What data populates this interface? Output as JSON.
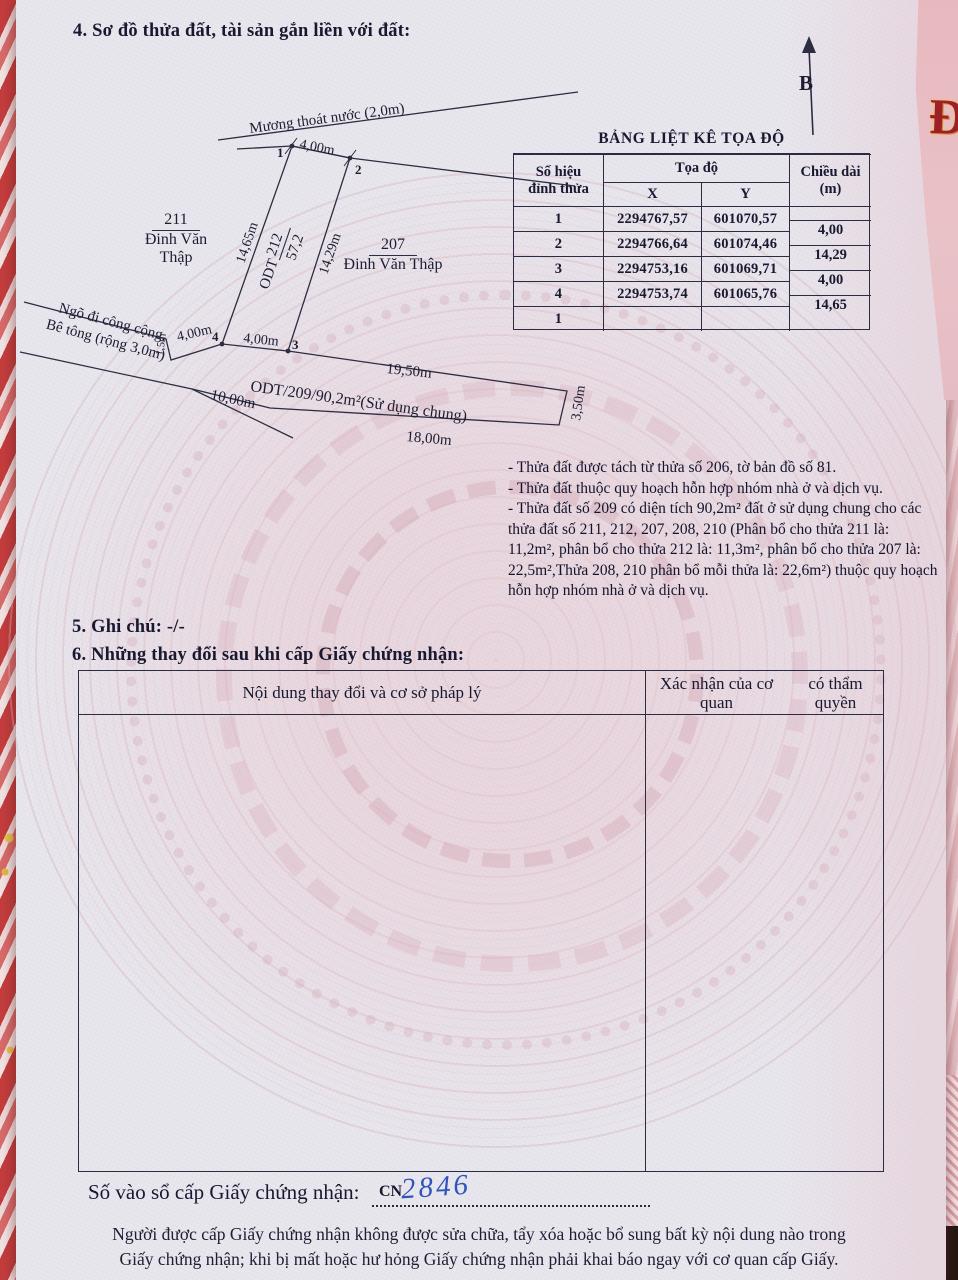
{
  "sections": {
    "sec4_title": "4. Sơ đồ thửa đất, tài sản gắn liền với đất:",
    "sec5_title": "5. Ghi chú: -/-",
    "sec6_title": "6. Những thay đổi sau khi cấp Giấy chứng nhận:"
  },
  "diagram": {
    "north_label": "B",
    "ditch_label": "Mương thoát nước (2,0m)",
    "top_edge": "4,00m",
    "left_edge": "14,65m",
    "right_edge": "14,29m",
    "front_edge_left": "4,00m",
    "front_edge_mid": "4,00m",
    "jog": "1,5m",
    "vertex1": "1",
    "vertex2": "2",
    "vertex3": "3",
    "vertex4": "4",
    "plot_prefix": "ODT",
    "plot_number": "212",
    "plot_area": "57,2",
    "neighbor_left_number": "211",
    "neighbor_left_owner": "Đinh Văn Thập",
    "neighbor_right_number": "207",
    "neighbor_right_owner": "Đinh Văn Thập",
    "path_label_line1": "Ngõ đi công cộng.",
    "path_label_line2": "Bê tông (rộng 3,0m)",
    "path_length": "10,00m",
    "strip_label": "ODT/209/90,2m²(Sử dụng chung)",
    "strip_top": "19,50m",
    "strip_bottom": "18,00m",
    "strip_right": "3,50m"
  },
  "coord_table": {
    "title": "BẢNG LIỆT KÊ TỌA ĐỘ",
    "headers": {
      "col1_line1": "Số hiệu",
      "col1_line2": "đỉnh thửa",
      "coord": "Tọa độ",
      "x": "X",
      "y": "Y",
      "len_line1": "Chiều dài",
      "len_line2": "(m)"
    },
    "rows": [
      {
        "id": "1",
        "x": "2294767,57",
        "y": "601070,57"
      },
      {
        "id": "2",
        "x": "2294766,64",
        "y": "601074,46"
      },
      {
        "id": "3",
        "x": "2294753,16",
        "y": "601069,71"
      },
      {
        "id": "4",
        "x": "2294753,74",
        "y": "601065,76"
      },
      {
        "id": "1",
        "x": "",
        "y": ""
      }
    ],
    "lengths": [
      "4,00",
      "14,29",
      "4,00",
      "14,65"
    ]
  },
  "notes": [
    "- Thửa đất được tách từ thửa số 206, tờ bản đồ số 81.",
    "- Thửa đất thuộc quy hoạch hỗn hợp nhóm nhà ở và dịch vụ.",
    "- Thửa đất số 209 có diện tích 90,2m² đất ở sử dụng chung cho các thửa đất số 211, 212, 207, 208, 210 (Phân bổ cho thửa 211 là: 11,2m², phân bổ cho thửa 212 là: 11,3m², phân bổ cho thửa 207 là: 22,5m²,Thửa 208, 210 phân bổ mỗi thửa là: 22,6m²) thuộc quy hoạch hỗn hợp nhóm nhà ở và dịch vụ."
  ],
  "changes_table": {
    "col1_header": "Nội dung thay đổi và cơ sở pháp lý",
    "col2_header_line1": "Xác nhận của cơ quan",
    "col2_header_line2": "có thẩm quyền"
  },
  "footer": {
    "registry_label": "Số vào sổ cấp Giấy chứng nhận:",
    "registry_prefix": "CN",
    "registry_number": "2846",
    "warning_line1": "Người được cấp Giấy chứng nhận không được sửa chữa, tẩy xóa hoặc bổ sung bất kỳ nội dung nào trong",
    "warning_line2": "Giấy chứng nhận; khi bị mất hoặc hư hỏng Giấy chứng nhận phải khai báo ngay với cơ quan cấp Giấy."
  },
  "cover_edge_text": "ĐẤ",
  "colors": {
    "page": "#e9e7ee",
    "ink": "#181830",
    "watermark_pink": "#d6acb7",
    "cover_red": "#c94b4b",
    "handwriting_blue": "#2f55bb",
    "edge_letter_red": "#9c2026"
  }
}
